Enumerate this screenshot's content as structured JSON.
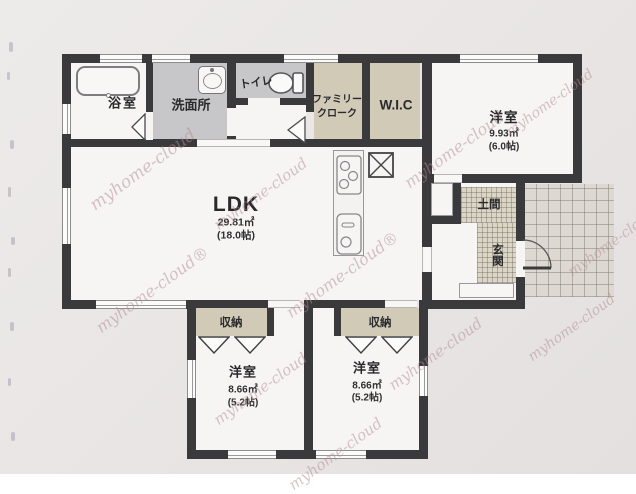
{
  "watermark": {
    "text": "myhome-cloud",
    "text_marked": "myhome-cloud®",
    "color": "#b28c8f"
  },
  "rooms": {
    "bathroom": {
      "label": "浴室"
    },
    "washroom": {
      "label": "洗面所"
    },
    "toilet": {
      "label": "トイレ"
    },
    "family_closet": {
      "line1": "ファミリー",
      "line2": "クローク"
    },
    "wic": {
      "label": "W.I.C"
    },
    "bedroom_ne": {
      "label": "洋室",
      "area": "9.93㎡",
      "tatami": "(6.0帖)"
    },
    "ldk": {
      "label": "LDK",
      "area": "29.81㎡",
      "tatami": "(18.0帖)"
    },
    "doma": {
      "label": "土間"
    },
    "genkan": {
      "label": "玄関"
    },
    "closet_sw": {
      "label": "収納"
    },
    "closet_se": {
      "label": "収納"
    },
    "bedroom_sw": {
      "label": "洋室",
      "area": "8.66㎡",
      "tatami": "(5.2帖)"
    },
    "bedroom_se": {
      "label": "洋室",
      "area": "8.66㎡",
      "tatami": "(5.2帖)"
    }
  },
  "colors": {
    "wall": "#3a393c",
    "floor_white": "#f6f5f3",
    "floor_gray": "#c7c6c9",
    "floor_beige": "#d1cab7",
    "hatch_bg": "#dbd5c6",
    "tile_bg": "#ddd9d2",
    "paper": "#e9e6e5"
  }
}
